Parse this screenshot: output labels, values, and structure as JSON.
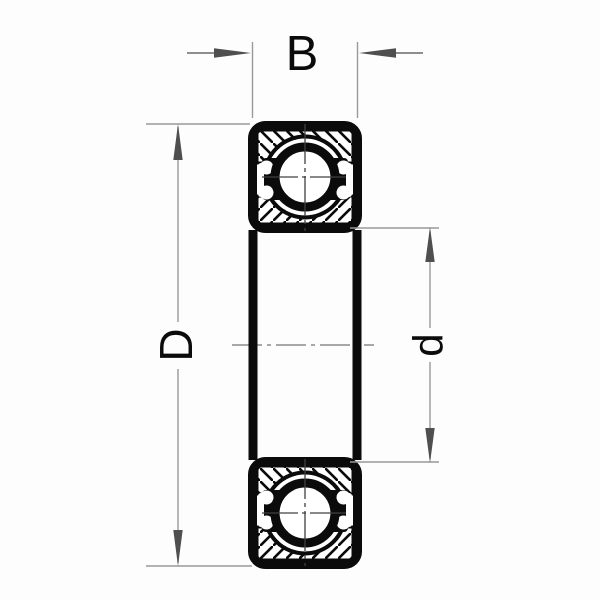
{
  "diagram": {
    "type": "ball-bearing-cross-section",
    "description": "Sealed deep groove ball bearing, side section view with dimension callouts",
    "labels": {
      "width": "B",
      "outer_diameter": "D",
      "bore_diameter": "d"
    },
    "colors": {
      "drawing_line": "#0b0b0b",
      "dimension_line": "#999999",
      "arrow": "#4f4f4f",
      "centerline": "#8c8c8c",
      "background": "#fdfdfd"
    }
  }
}
